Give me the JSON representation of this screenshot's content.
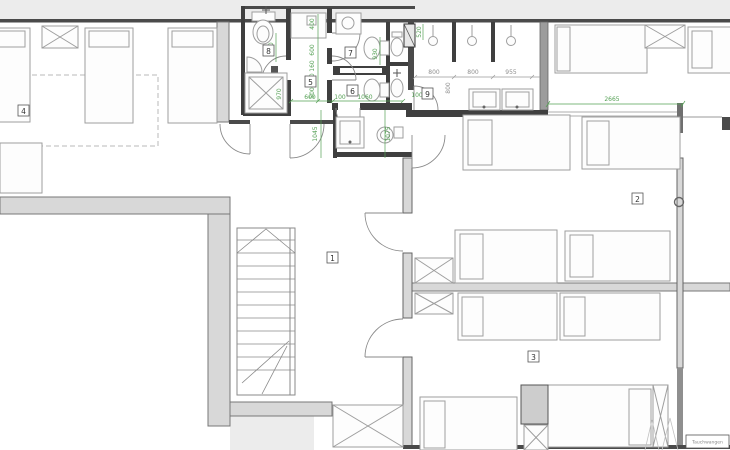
{
  "drawing": {
    "rooms": {
      "r1": "1",
      "r2": "2",
      "r3": "3",
      "r4": "4",
      "r5": "5",
      "r6": "6",
      "r7": "7",
      "r8": "8",
      "r9": "9"
    },
    "dims_green": {
      "g400": "400",
      "g600a": "600",
      "g160": "160",
      "g360": "360",
      "g500": "500",
      "g600b": "600",
      "g100a": "100",
      "g1060": "1060",
      "g930": "930",
      "g1045": "1045",
      "g1075": "1075",
      "g950": "950",
      "g970": "970",
      "g520": "520",
      "g100b": "100",
      "g2665": "2665"
    },
    "dims_gray": {
      "d800a": "800",
      "d800b": "800",
      "d800c": "800",
      "d955": "955"
    },
    "title_block": "Tauchwangen",
    "colors": {
      "dim_green": "#55a055",
      "wall_dark": "#454545",
      "wall_fill": "#d8d8d8",
      "outside": "#ececec"
    }
  }
}
